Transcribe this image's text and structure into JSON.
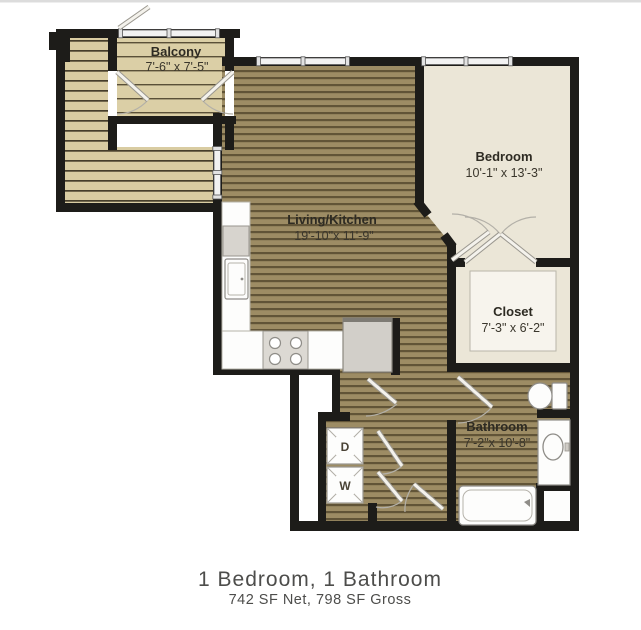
{
  "floorplan": {
    "rooms": {
      "balcony": {
        "name": "Balcony",
        "dims": "7'-6\" x 7'-5\""
      },
      "living_kitchen": {
        "name": "Living/Kitchen",
        "dims": "19'-10\"x 11'-9\""
      },
      "bedroom": {
        "name": "Bedroom",
        "dims": "10'-1\" x 13'-3\""
      },
      "closet": {
        "name": "Closet",
        "dims": "7'-3\" x 6'-2\""
      },
      "bathroom": {
        "name": "Bathroom",
        "dims": "7'-2\"x 10'-8\""
      }
    },
    "appliances": {
      "dryer": "D",
      "washer": "W"
    },
    "caption": {
      "title": "1 Bedroom, 1 Bathroom",
      "subtitle": "742 SF Net, 798 SF Gross"
    },
    "palette": {
      "wall": "#1d1c19",
      "deck_floor": "#d9cca2",
      "wood_floor": "#9d8c64",
      "wood_stripe": "#615437",
      "room_floor": "#ebe6d7",
      "fixture_outline": "#8f8d88"
    }
  }
}
